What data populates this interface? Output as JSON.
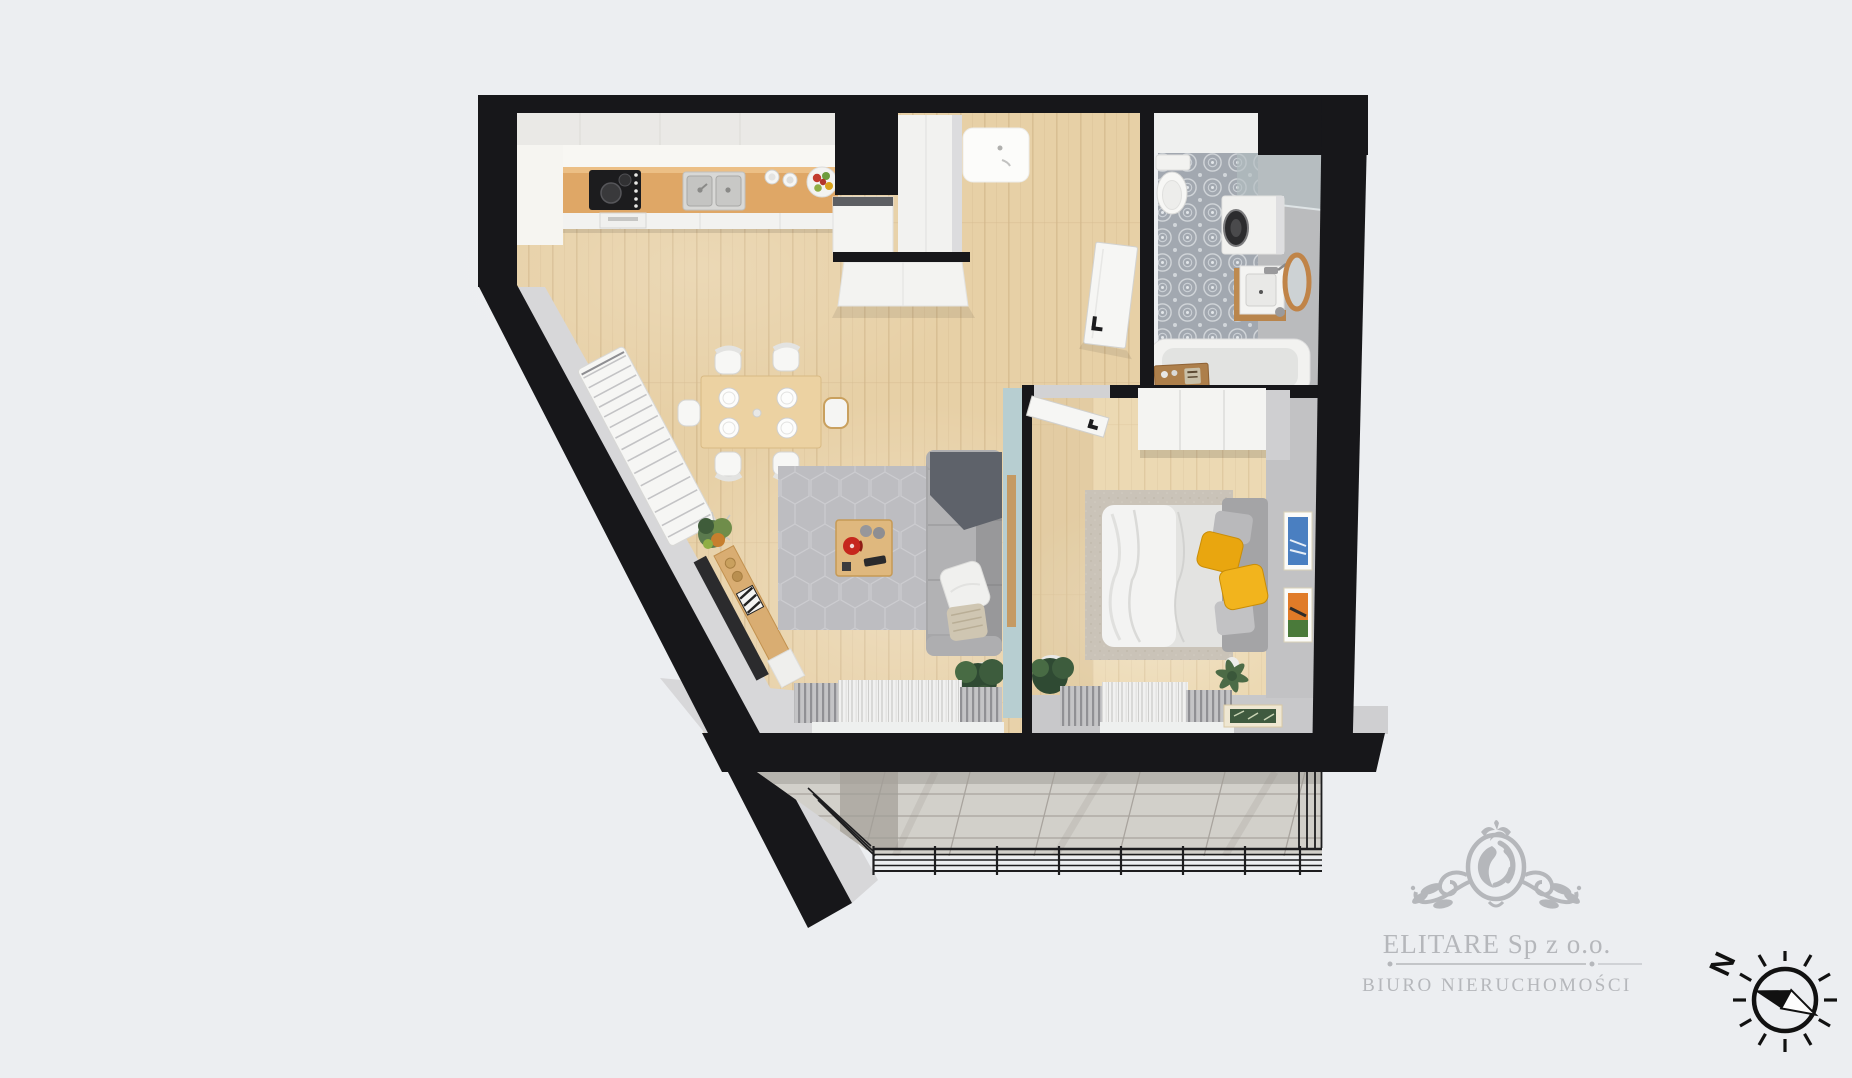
{
  "watermark": {
    "company": "ELITARE Sp z o.o.",
    "tagline": "BIURO NIERUCHOMOŚCI"
  },
  "compass": {
    "north_label": "N"
  },
  "colors": {
    "background": "#eceef1",
    "wall": "#17171a",
    "wall_face": "#d7d7d9",
    "wood_floor": "#e7d0a6",
    "wood_floor_dark": "#d5ba8e",
    "bedroom_floor": "#ecd9b3",
    "counter_wood": "#dfa766",
    "bath_tile": "#a2a8b0",
    "teal_wall": "#b7ced1",
    "sofa_gray": "#a7a7a9",
    "rug_gray": "#bdbdc1",
    "bedroom_rug": "#cac3b8",
    "accent_yellow": "#e9a60f",
    "accent_red": "#c6271d",
    "balcony_concrete": "#d2d0ca",
    "railing": "#1d1d1f",
    "watermark_gray": "#b5b7bb"
  }
}
